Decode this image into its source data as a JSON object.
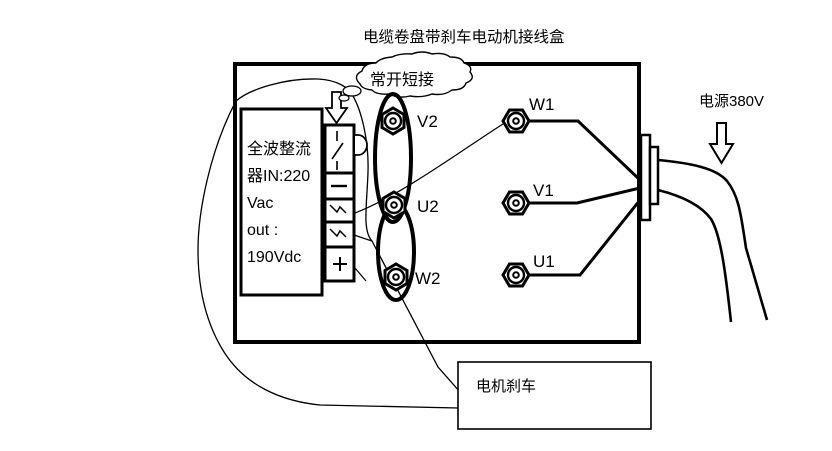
{
  "title": "电缆卷盘带刹车电动机接线盒",
  "callout": {
    "text": "常开短接"
  },
  "rectifier": {
    "lines": [
      "全波整流",
      "器IN:220",
      "Vac",
      "out :",
      "190Vdc"
    ]
  },
  "terminal_strip": {
    "cell_symbols": [
      "disconnect-switch",
      "minus",
      "ac-wave",
      "ac-wave",
      "plus"
    ]
  },
  "terminals": {
    "link_side": [
      {
        "label": "V2"
      },
      {
        "label": "U2"
      },
      {
        "label": "W2"
      }
    ],
    "supply_side": [
      {
        "label": "W1"
      },
      {
        "label": "V1"
      },
      {
        "label": "U1"
      }
    ]
  },
  "power": {
    "label": "电源380V"
  },
  "brake": {
    "label": "电机刹车"
  },
  "icons": {
    "strip_pointer": "down-outline-arrow",
    "power_pointer": "down-outline-arrow",
    "callout_shape": "cloud-bubble",
    "terminal_shape": "hex-bolt",
    "link_shape": "oval-jumper"
  },
  "colors": {
    "ink": "#000000",
    "background": "#ffffff"
  }
}
